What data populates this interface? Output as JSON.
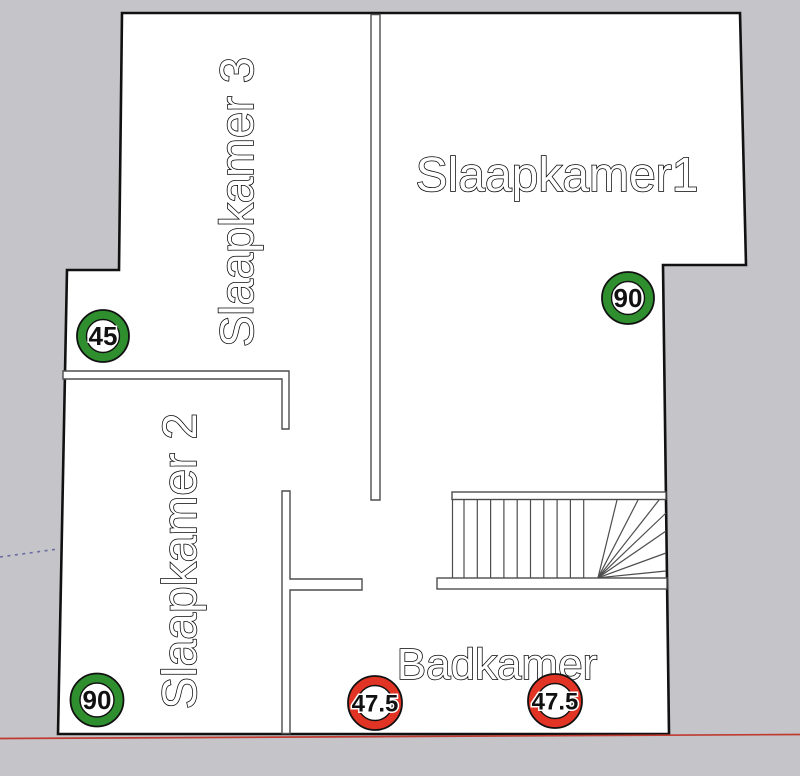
{
  "scene": {
    "type": "floor-plan",
    "description": "Top view floor plan of an upper storey with bedrooms, bathroom and staircase"
  },
  "rooms": [
    {
      "id": "slaapkamer3",
      "label": "Slaapkamer 3",
      "orientation": "vertical"
    },
    {
      "id": "slaapkamer1",
      "label": "Slaapkamer1",
      "orientation": "horizontal"
    },
    {
      "id": "slaapkamer2",
      "label": "Slaapkamer 2",
      "orientation": "vertical"
    },
    {
      "id": "badkamer",
      "label": "Badkamer",
      "orientation": "horizontal"
    }
  ],
  "measurements": [
    {
      "value": "45",
      "color": "green",
      "location": "left-upper"
    },
    {
      "value": "90",
      "color": "green",
      "location": "right-upper"
    },
    {
      "value": "90",
      "color": "green",
      "location": "left-lower"
    },
    {
      "value": "47.5",
      "color": "red",
      "location": "bathroom-left"
    },
    {
      "value": "47.5",
      "color": "red",
      "location": "bathroom-right"
    }
  ],
  "colors": {
    "background": "#c5c5c9",
    "floor_fill": "#ffffff",
    "wall_stroke": "#111111",
    "interior_stroke": "#4d4d4d",
    "badge_green": "#2f8f2f",
    "badge_red": "#e23424",
    "axis_red": "#bf3a30",
    "axis_dotted_blue": "#6b6ba3"
  }
}
